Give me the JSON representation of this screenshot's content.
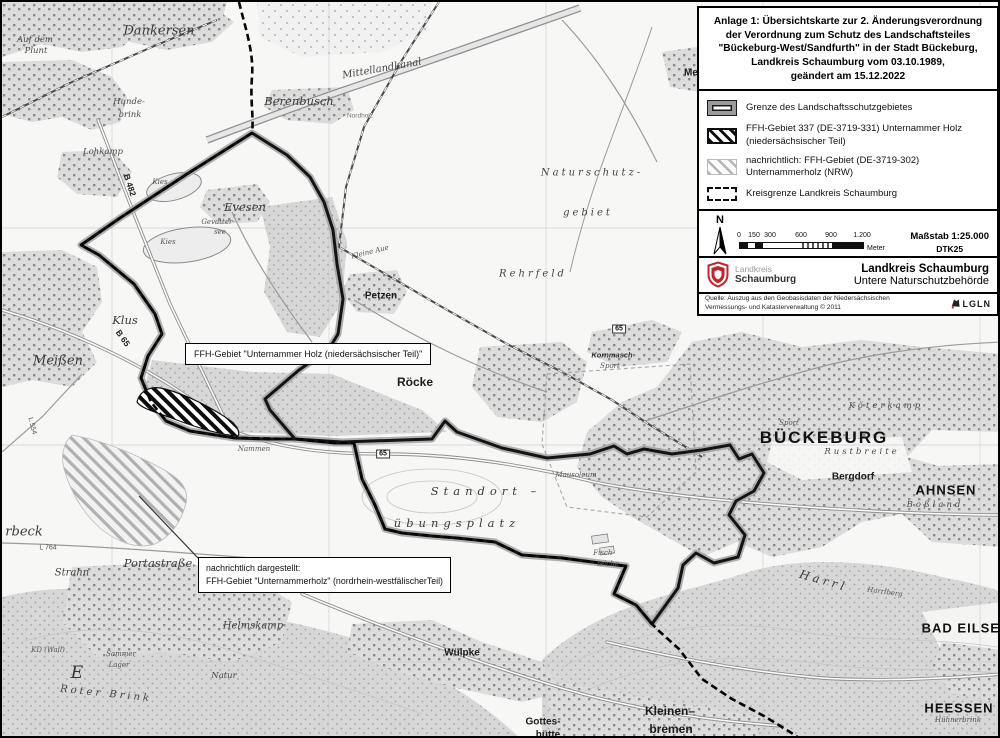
{
  "title_block": {
    "lines": [
      "Anlage 1: Übersichtskarte zur 2. Änderungsverordnung",
      "der Verordnung zum Schutz des Landschaftsteiles",
      "\"Bückeburg-West/Sandfurth\"  in der Stadt Bückeburg,",
      "Landkreis Schaumburg vom 03.10.1989,",
      "geändert am 15.12.2022"
    ]
  },
  "legend": {
    "items": [
      {
        "label": "Grenze des Landschaftsschutzgebietes"
      },
      {
        "label": "FFH-Gebiet 337 (DE-3719-331) Unternammer Holz (niedersächsischer Teil)"
      },
      {
        "label": "nachrichtlich:  FFH-Gebiet (DE-3719-302) Unternammerholz (NRW)"
      },
      {
        "label": "Kreisgrenze Landkreis Schaumburg"
      }
    ]
  },
  "scale_bar": {
    "north": "N",
    "ticks": [
      "0",
      "150",
      "300",
      "600",
      "900",
      "1.200"
    ],
    "unit": "Meter",
    "scale_label": "Maßstab 1:25.000",
    "basemap_label": "DTK25"
  },
  "agency_block": {
    "logo_line1": "Landkreis",
    "logo_line2": "Schaumburg",
    "name": "Landkreis Schaumburg",
    "department": "Untere Naturschutzbehörde"
  },
  "source_block": {
    "text": "Quelle: Auszug aus den Geobasisdaten der Niedersächsischen Vermessungs- und Katasterverwaltung © 2011",
    "logo_text": "LGLN"
  },
  "callouts": {
    "ffh_nds": "FFH-Gebiet \"Unternammer Holz (niedersächsischer Teil)\"",
    "ffh_nrw": {
      "line1": "nachrichtlich dargestellt:",
      "line2": "FFH-Gebiet \"Unternammerholz\" (nordrhein-westfälischerTeil)"
    }
  },
  "map_labels": [
    {
      "t": "Dankersen",
      "x": 157,
      "y": 29,
      "c": "serif-lg"
    },
    {
      "t": "Auf dem",
      "x": 33,
      "y": 38,
      "c": "serif-xs"
    },
    {
      "t": "Plunt",
      "x": 34,
      "y": 49,
      "c": "serif-xs"
    },
    {
      "t": "Hunde-",
      "x": 127,
      "y": 100,
      "c": "serif-xs"
    },
    {
      "t": "brink",
      "x": 128,
      "y": 113,
      "c": "serif-xs"
    },
    {
      "t": "Berenbusch",
      "x": 297,
      "y": 99,
      "c": "serif-md"
    },
    {
      "t": "Mittellandkanal",
      "x": 380,
      "y": 67,
      "c": "serif-sm",
      "r": -10
    },
    {
      "t": "Nordholz",
      "x": 358,
      "y": 114,
      "c": "sans-xxs"
    },
    {
      "t": "Lohkamp",
      "x": 101,
      "y": 150,
      "c": "serif-xs"
    },
    {
      "t": "Kies",
      "x": 158,
      "y": 180,
      "c": "serif-xxs"
    },
    {
      "t": "Kies",
      "x": 166,
      "y": 240,
      "c": "serif-xxs"
    },
    {
      "t": "Evesen",
      "x": 243,
      "y": 205,
      "c": "serif-md"
    },
    {
      "t": "Gevatter-",
      "x": 216,
      "y": 220,
      "c": "serif-xxs"
    },
    {
      "t": "see",
      "x": 218,
      "y": 230,
      "c": "serif-xxs"
    },
    {
      "t": "B 482",
      "x": 128,
      "y": 183,
      "c": "road-lbl",
      "r": 72
    },
    {
      "t": "Klus",
      "x": 123,
      "y": 318,
      "c": "serif-md"
    },
    {
      "t": "B 65",
      "x": 121,
      "y": 336,
      "c": "road-lbl",
      "r": 55
    },
    {
      "t": "Meißen",
      "x": 56,
      "y": 359,
      "c": "serif-lg"
    },
    {
      "t": "L 554",
      "x": 30,
      "y": 424,
      "c": "road-xs",
      "r": 75
    },
    {
      "t": "Petzen",
      "x": 379,
      "y": 294,
      "c": "sans-sm-bold"
    },
    {
      "t": "Kleine Aue",
      "x": 368,
      "y": 250,
      "c": "serif-xxs",
      "r": -14
    },
    {
      "t": "Rehrfeld",
      "x": 531,
      "y": 272,
      "c": "serif-sm spread"
    },
    {
      "t": "Kornmasch",
      "x": 610,
      "y": 353,
      "c": "sans-xxs-b"
    },
    {
      "t": "Sport",
      "x": 608,
      "y": 364,
      "c": "serif-xxs"
    },
    {
      "t": "Röcke",
      "x": 413,
      "y": 380,
      "c": "sans-md-bold"
    },
    {
      "t": "Naturschutz-",
      "x": 590,
      "y": 171,
      "c": "serif-sm spread"
    },
    {
      "t": "gebiet",
      "x": 586,
      "y": 211,
      "c": "serif-sm spread"
    },
    {
      "t": "Me",
      "x": 689,
      "y": 71,
      "c": "sans-sm-bold"
    },
    {
      "t": "BÜCKEBURG",
      "x": 822,
      "y": 436,
      "c": "city-lg"
    },
    {
      "t": "Köterkamp",
      "x": 884,
      "y": 404,
      "c": "serif-xs spread"
    },
    {
      "t": "Rustbreite",
      "x": 860,
      "y": 450,
      "c": "serif-xs spread"
    },
    {
      "t": "Bergdorf",
      "x": 851,
      "y": 475,
      "c": "sans-sm-bold"
    },
    {
      "t": "AHNSEN",
      "x": 944,
      "y": 488,
      "c": "city-md"
    },
    {
      "t": "Boßland",
      "x": 933,
      "y": 503,
      "c": "serif-xs spread"
    },
    {
      "t": "Standort –",
      "x": 484,
      "y": 489,
      "c": "serif-md spread2"
    },
    {
      "t": "übungsplatz",
      "x": 455,
      "y": 521,
      "c": "serif-md spread2"
    },
    {
      "t": "Mausoleum",
      "x": 574,
      "y": 473,
      "c": "serif-xxs"
    },
    {
      "t": "Fisch-",
      "x": 602,
      "y": 551,
      "c": "serif-xxs"
    },
    {
      "t": "teiche",
      "x": 606,
      "y": 562,
      "c": "serif-xxs"
    },
    {
      "t": "Sport",
      "x": 787,
      "y": 421,
      "c": "serif-xxs"
    },
    {
      "t": "BAD EILSEN",
      "x": 964,
      "y": 626,
      "c": "city-md"
    },
    {
      "t": "HEESSEN",
      "x": 957,
      "y": 706,
      "c": "city-md"
    },
    {
      "t": "Hühnerbrink",
      "x": 956,
      "y": 718,
      "c": "serif-xxs"
    },
    {
      "t": "H a r r l",
      "x": 820,
      "y": 578,
      "c": "serif-md",
      "r": 16
    },
    {
      "t": "Harrlberg",
      "x": 883,
      "y": 590,
      "c": "serif-xxs",
      "r": 8
    },
    {
      "t": "Kleinen–",
      "x": 668,
      "y": 709,
      "c": "sans-md-bold"
    },
    {
      "t": "bremen",
      "x": 669,
      "y": 727,
      "c": "sans-md-bold"
    },
    {
      "t": "Wülpke",
      "x": 460,
      "y": 651,
      "c": "sans-sm-bold"
    },
    {
      "t": "Gottes-",
      "x": 541,
      "y": 720,
      "c": "sans-sm-bold"
    },
    {
      "t": "hütte",
      "x": 546,
      "y": 733,
      "c": "sans-sm-bold"
    },
    {
      "t": "Strahn",
      "x": 70,
      "y": 571,
      "c": "serif-sm"
    },
    {
      "t": "Portastraße",
      "x": 156,
      "y": 561,
      "c": "serif-md"
    },
    {
      "t": "rbeck",
      "x": 22,
      "y": 530,
      "c": "serif-lg"
    },
    {
      "t": "L 764",
      "x": 46,
      "y": 546,
      "c": "road-xs"
    },
    {
      "t": "Helmskamp",
      "x": 251,
      "y": 624,
      "c": "serif-sm"
    },
    {
      "t": "Roter Brink",
      "x": 104,
      "y": 692,
      "c": "serif-sm spread",
      "r": 6
    },
    {
      "t": "Sammer",
      "x": 119,
      "y": 652,
      "c": "serif-xxs"
    },
    {
      "t": "Lager",
      "x": 117,
      "y": 663,
      "c": "serif-xxs"
    },
    {
      "t": "KD (Wall)",
      "x": 46,
      "y": 648,
      "c": "serif-xxs"
    },
    {
      "t": "E",
      "x": 75,
      "y": 671,
      "c": "serif-xl"
    },
    {
      "t": "Natur",
      "x": 222,
      "y": 674,
      "c": "serif-xs"
    },
    {
      "t": "Nammen",
      "x": 252,
      "y": 447,
      "c": "serif-xxs"
    },
    {
      "t": "65",
      "x": 381,
      "y": 452,
      "c": "badge"
    },
    {
      "t": "65",
      "x": 617,
      "y": 327,
      "c": "badge"
    }
  ]
}
